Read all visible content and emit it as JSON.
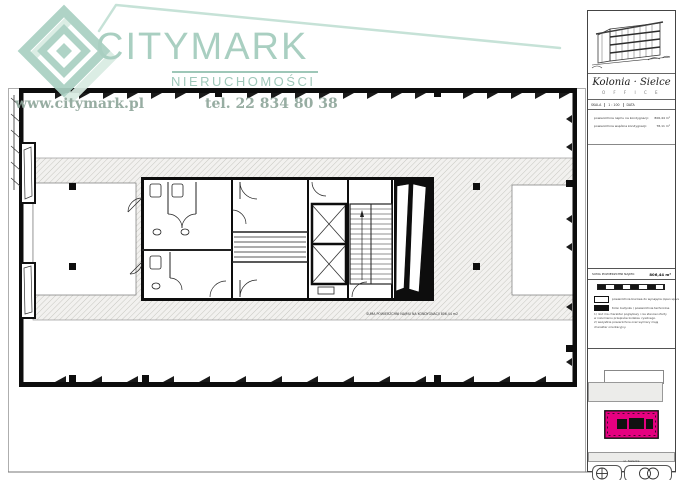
{
  "brand": {
    "logo": "citymark-diamond",
    "name": "CITYMARK",
    "subtitle": "NIERUCHOMOŚCI",
    "website": "www.citymark.pl",
    "phone": "tel. 22 834 80 38"
  },
  "colors": {
    "watermark_teal": "#a3ccbd",
    "watermark_soft": "#c2e0d5",
    "serif_gray_green": "#90a79c",
    "site_highlight_magenta": "#e60080",
    "hatch_line": "#bcbcb6",
    "wall_black": "#0d0d0d"
  },
  "plan": {
    "floor_note": "SUMA POWIERZCHNI NAJMU NA KONDYGNACJI 806,44 m2"
  },
  "titleblock": {
    "project_name": "Kolonia · Sielce",
    "project_subtitle": "O F F I C E",
    "meta": {
      "c1": "SKALA",
      "c2": "1 : 100",
      "c3": "DATA"
    },
    "info_rows": [
      {
        "label": "powierzchnia najmu na kondygnacji:",
        "value": "806,44 m²"
      },
      {
        "label": "powierzchnia wspólna kondygnacji:",
        "value": "78,11 m²"
      }
    ],
    "area_row": {
      "label": "SUMA POWIERZCHNI NAJMU:",
      "value": "806,44 m²"
    },
    "legend": [
      {
        "swatch": "white",
        "label": "powierzchnia biurowa do wynajęcia (open space)"
      },
      {
        "swatch": "black",
        "label": "trzon budynku / powierzchnie techniczne"
      }
    ],
    "notes": [
      "1) rzut ma charakter poglądowy i nie stanowi oferty",
      "w rozumieniu przepisów kodeksu cywilnego.",
      "2) wszystkie powierzchnie oraz wymiary mają",
      "charakter orientacyjny."
    ],
    "site_label": "ul. Sielecka"
  }
}
